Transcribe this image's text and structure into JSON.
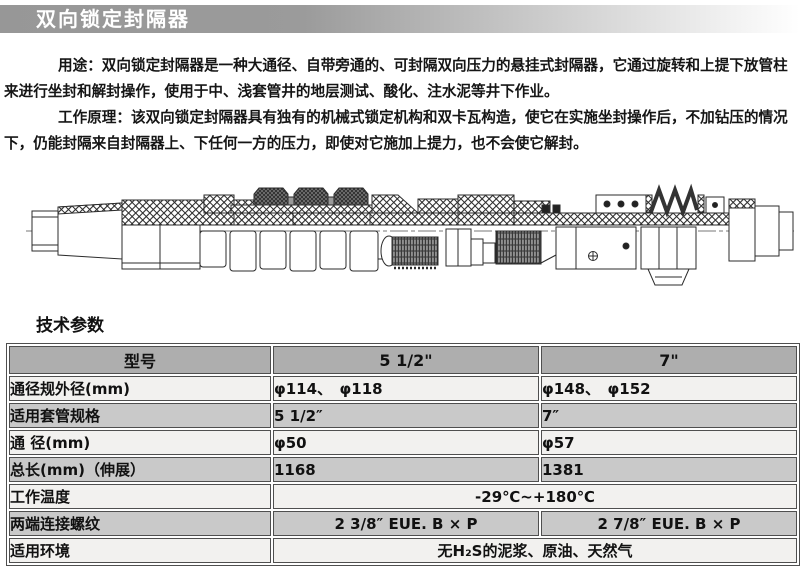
{
  "title_bar": {
    "text": "双向锁定封隔器"
  },
  "intro": {
    "usage_lines": [
      "用途：双向锁定封隔器是一种大通径、自带旁通的、可封隔双向压力的悬挂式封隔器，它通过旋转和上提下放管柱",
      "来进行坐封和解封操作，使用于中、浅套管井的地层测试、酸化、注水泥等井下作业。"
    ],
    "principle_lines": [
      "工作原理：该双向锁定封隔器具有独有的机械式锁定机构和双卡瓦构造，使它在实施坐封操作后，不加钻压的情况",
      "下，仍能封隔来自封隔器上、下任何一方的压力，即使对它施加上提力，也不会使它解封。"
    ]
  },
  "section_heading": "技术参数",
  "table": {
    "header": [
      "型号",
      "5 1/2\"",
      "7\""
    ],
    "rows": [
      {
        "label": "通径规外径(mm)",
        "values": [
          "φ114、　φ118",
          "φ148、　φ152"
        ]
      },
      {
        "label": "适用套管规格",
        "values": [
          "5 1/2″",
          "7″"
        ]
      },
      {
        "label": "通 径(mm)",
        "values": [
          "φ50",
          "φ57"
        ]
      },
      {
        "label": "总长(mm)（伸展）",
        "values": [
          "1168",
          "1381"
        ]
      },
      {
        "label": "工作温度",
        "span_value": "-29℃~+180℃"
      },
      {
        "label": "两端连接螺纹",
        "values": [
          "2 3/8″ EUE. B × P",
          "2 7/8″ EUE. B × P"
        ]
      },
      {
        "label": "适用环境",
        "span_value": "无H₂S的泥浆、原油、天然气"
      }
    ]
  },
  "colors": {
    "title_bar_gray": "#999999",
    "table_header_bg": "#aeaeae",
    "row_light": "#f2f1ef",
    "row_dark": "#c9c9c9",
    "border": "#4f4f4f"
  }
}
